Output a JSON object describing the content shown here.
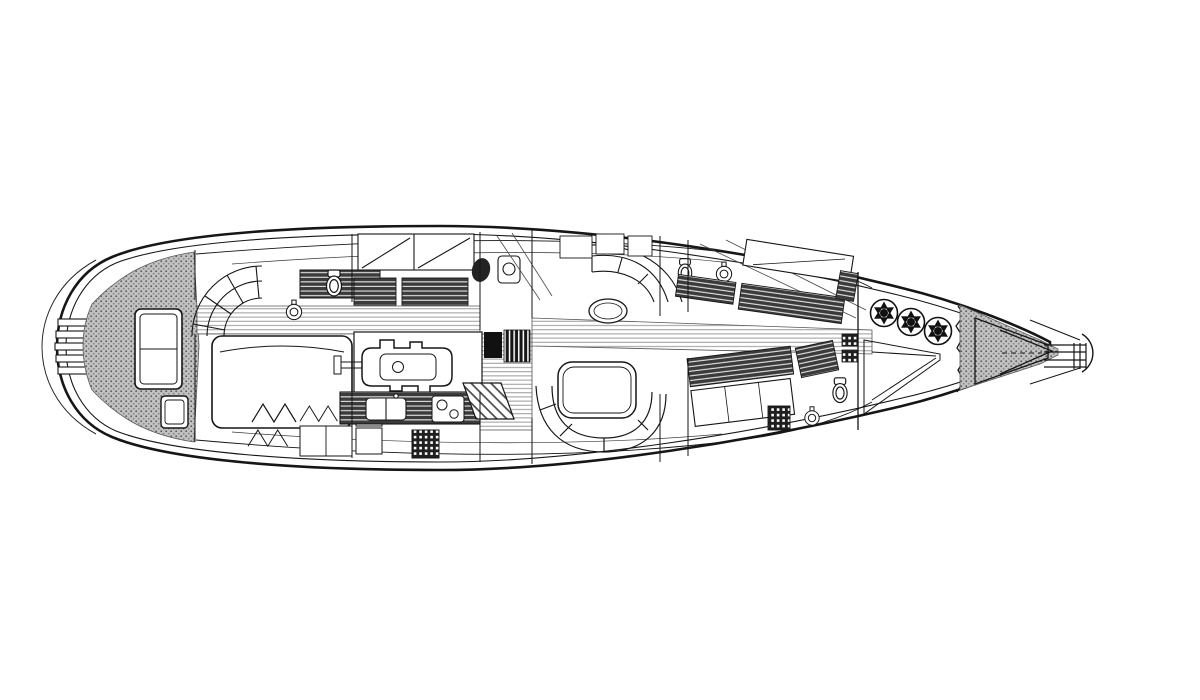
{
  "document": {
    "title": "Sailing yacht interior and deck arrangement plan, top view line drawing, bow pointing right"
  },
  "palette": {
    "ink": "#161616",
    "paper": "#ffffff",
    "deck_texture_gray": "#c2c2c2",
    "furniture_hatch_dark": "#3b3b3b",
    "sole_stripe_gray": "#9b9b9b"
  },
  "labels": {
    "canvas": "Yacht arrangement plan drawing",
    "hull": "Hull and deck outline with sheer lines",
    "stern_platform": "Rounded transom with swim steps",
    "aft_deck": "Textured aft deck with deck hatches",
    "owners_cabin": "Aft owner's cabin: curved settee, double berth, head with toilet and basin",
    "passage": "Centerline passageway with striped cabin sole",
    "crew_cabin": "Aft crew cabin with bunk berths, WC and shower",
    "engine_room": "Engine room with main engine and shaft",
    "mast_station": "Mast step with halyard winch bank",
    "galley": "Galley with counter, sink, stove, bottle rack and companionway stairs",
    "saloon": "Saloon with U-shaped settees and tables",
    "fwd_cabin_upper": "Forward cabin (upper side) with berths and head",
    "fwd_cabin_lower": "Forward cabin (lower side) with berths and head",
    "forepeak": "Forepeak sail locker with three furling drums and sail bins",
    "bow_deck": "Textured foredeck with anchor locker panels",
    "bowsprit": "Stem fitting with anchor roller and pulpit"
  },
  "components": [
    {
      "name": "swim-steps",
      "count": 5
    },
    {
      "name": "aft-deck-hatch",
      "count": 2
    },
    {
      "name": "double-berth",
      "count": 1
    },
    {
      "name": "toilet",
      "count": 4
    },
    {
      "name": "washbasin",
      "count": 3
    },
    {
      "name": "engine",
      "count": 1
    },
    {
      "name": "winch-grille",
      "count": 1
    },
    {
      "name": "saloon-table",
      "count": 2
    },
    {
      "name": "furling-drum",
      "count": 3
    },
    {
      "name": "anchor-roller",
      "count": 1
    }
  ]
}
